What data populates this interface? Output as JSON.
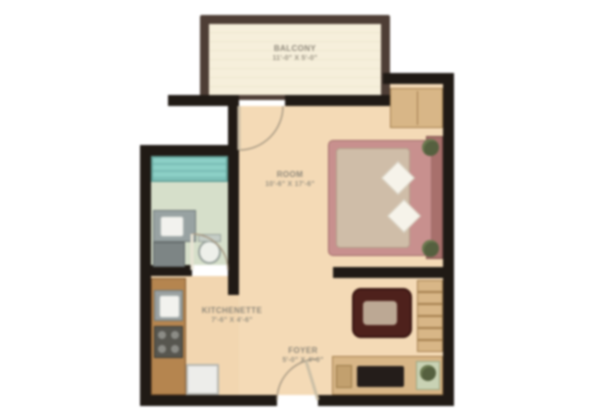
{
  "plan_title": "studio-apartment-floor-plan",
  "rooms": {
    "balcony": {
      "name": "BALCONY",
      "dims": "11'-0\" X 5'-0\""
    },
    "room": {
      "name": "ROOM",
      "dims": "10'-6\" X 17'-6\""
    },
    "kitchenette": {
      "name": "KITCHENETTE",
      "dims": "7'-6\" X 4'-6\""
    },
    "foyer": {
      "name": "FOYER",
      "dims": "5'-0\" X 4'-0\""
    }
  },
  "fixtures": [
    "bathtub",
    "vanity-sink",
    "toilet",
    "kitchen-counter",
    "kitchen-sink",
    "stove",
    "fridge",
    "wardrobe",
    "double-bed",
    "pillows",
    "nightstand-plants",
    "shelving-unit",
    "coffee-table",
    "tv-console",
    "planter-box",
    "balcony-door",
    "bathroom-door",
    "entry-door"
  ],
  "colors": {
    "wall": "#201a15",
    "floor": "#f4dab6",
    "balcony_wall": "#4e3e36",
    "balcony_floor": "#f6efdb",
    "bath_tile": "#8ccfc6",
    "bath_floor": "#d6dfca",
    "bed_frame": "#c8908e",
    "duvet": "#cfbda8",
    "wood_furniture": "#d8b687",
    "coffee_table": "#4e211c",
    "label_text": "#8f887a"
  }
}
